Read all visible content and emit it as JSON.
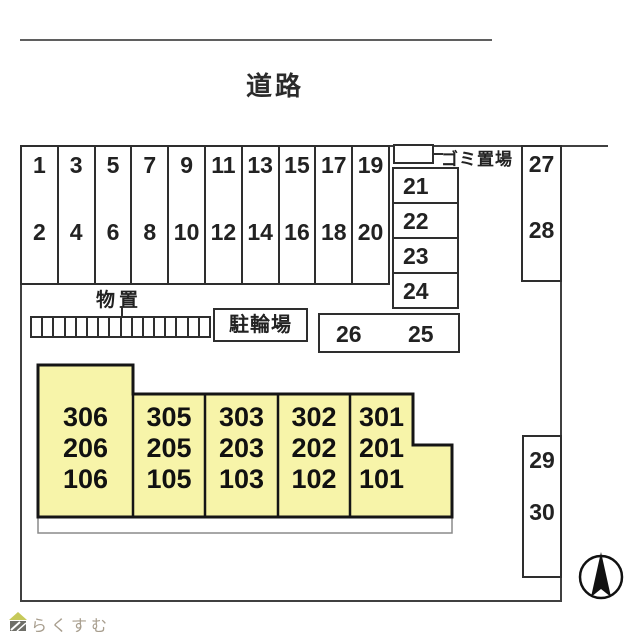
{
  "road": {
    "label": "道路"
  },
  "parking": {
    "front_columns": [
      {
        "top": "1",
        "bottom": "2"
      },
      {
        "top": "3",
        "bottom": "4"
      },
      {
        "top": "5",
        "bottom": "6"
      },
      {
        "top": "7",
        "bottom": "8"
      },
      {
        "top": "9",
        "bottom": "10"
      },
      {
        "top": "11",
        "bottom": "12"
      },
      {
        "top": "13",
        "bottom": "14"
      },
      {
        "top": "15",
        "bottom": "16"
      },
      {
        "top": "17",
        "bottom": "18"
      },
      {
        "top": "19",
        "bottom": "20"
      }
    ],
    "side_rows": [
      "21",
      "22",
      "23",
      "24"
    ],
    "pair_box": {
      "left": "26",
      "right": "25"
    },
    "upper_right_column": {
      "top": "27",
      "bottom": "28"
    },
    "lower_right_column": {
      "top": "29",
      "bottom": "30"
    }
  },
  "facilities": {
    "storage_label": "物置",
    "storage_unit_count": 16,
    "bicycle_parking_label": "駐輪場",
    "garbage_area_label": "ゴミ置場"
  },
  "building": {
    "units": [
      {
        "rooms": [
          "306",
          "206",
          "106"
        ]
      },
      {
        "rooms": [
          "305",
          "205",
          "105"
        ]
      },
      {
        "rooms": [
          "303",
          "203",
          "103"
        ]
      },
      {
        "rooms": [
          "302",
          "202",
          "102"
        ]
      },
      {
        "rooms": [
          "301",
          "201",
          "101"
        ]
      }
    ]
  },
  "footer": {
    "logo_text": "らくすむ"
  },
  "colors": {
    "boundary_line": "#404040",
    "building_fill": "#f7f4a9",
    "building_border": "#151515",
    "logo_text": "#a89e8e"
  }
}
